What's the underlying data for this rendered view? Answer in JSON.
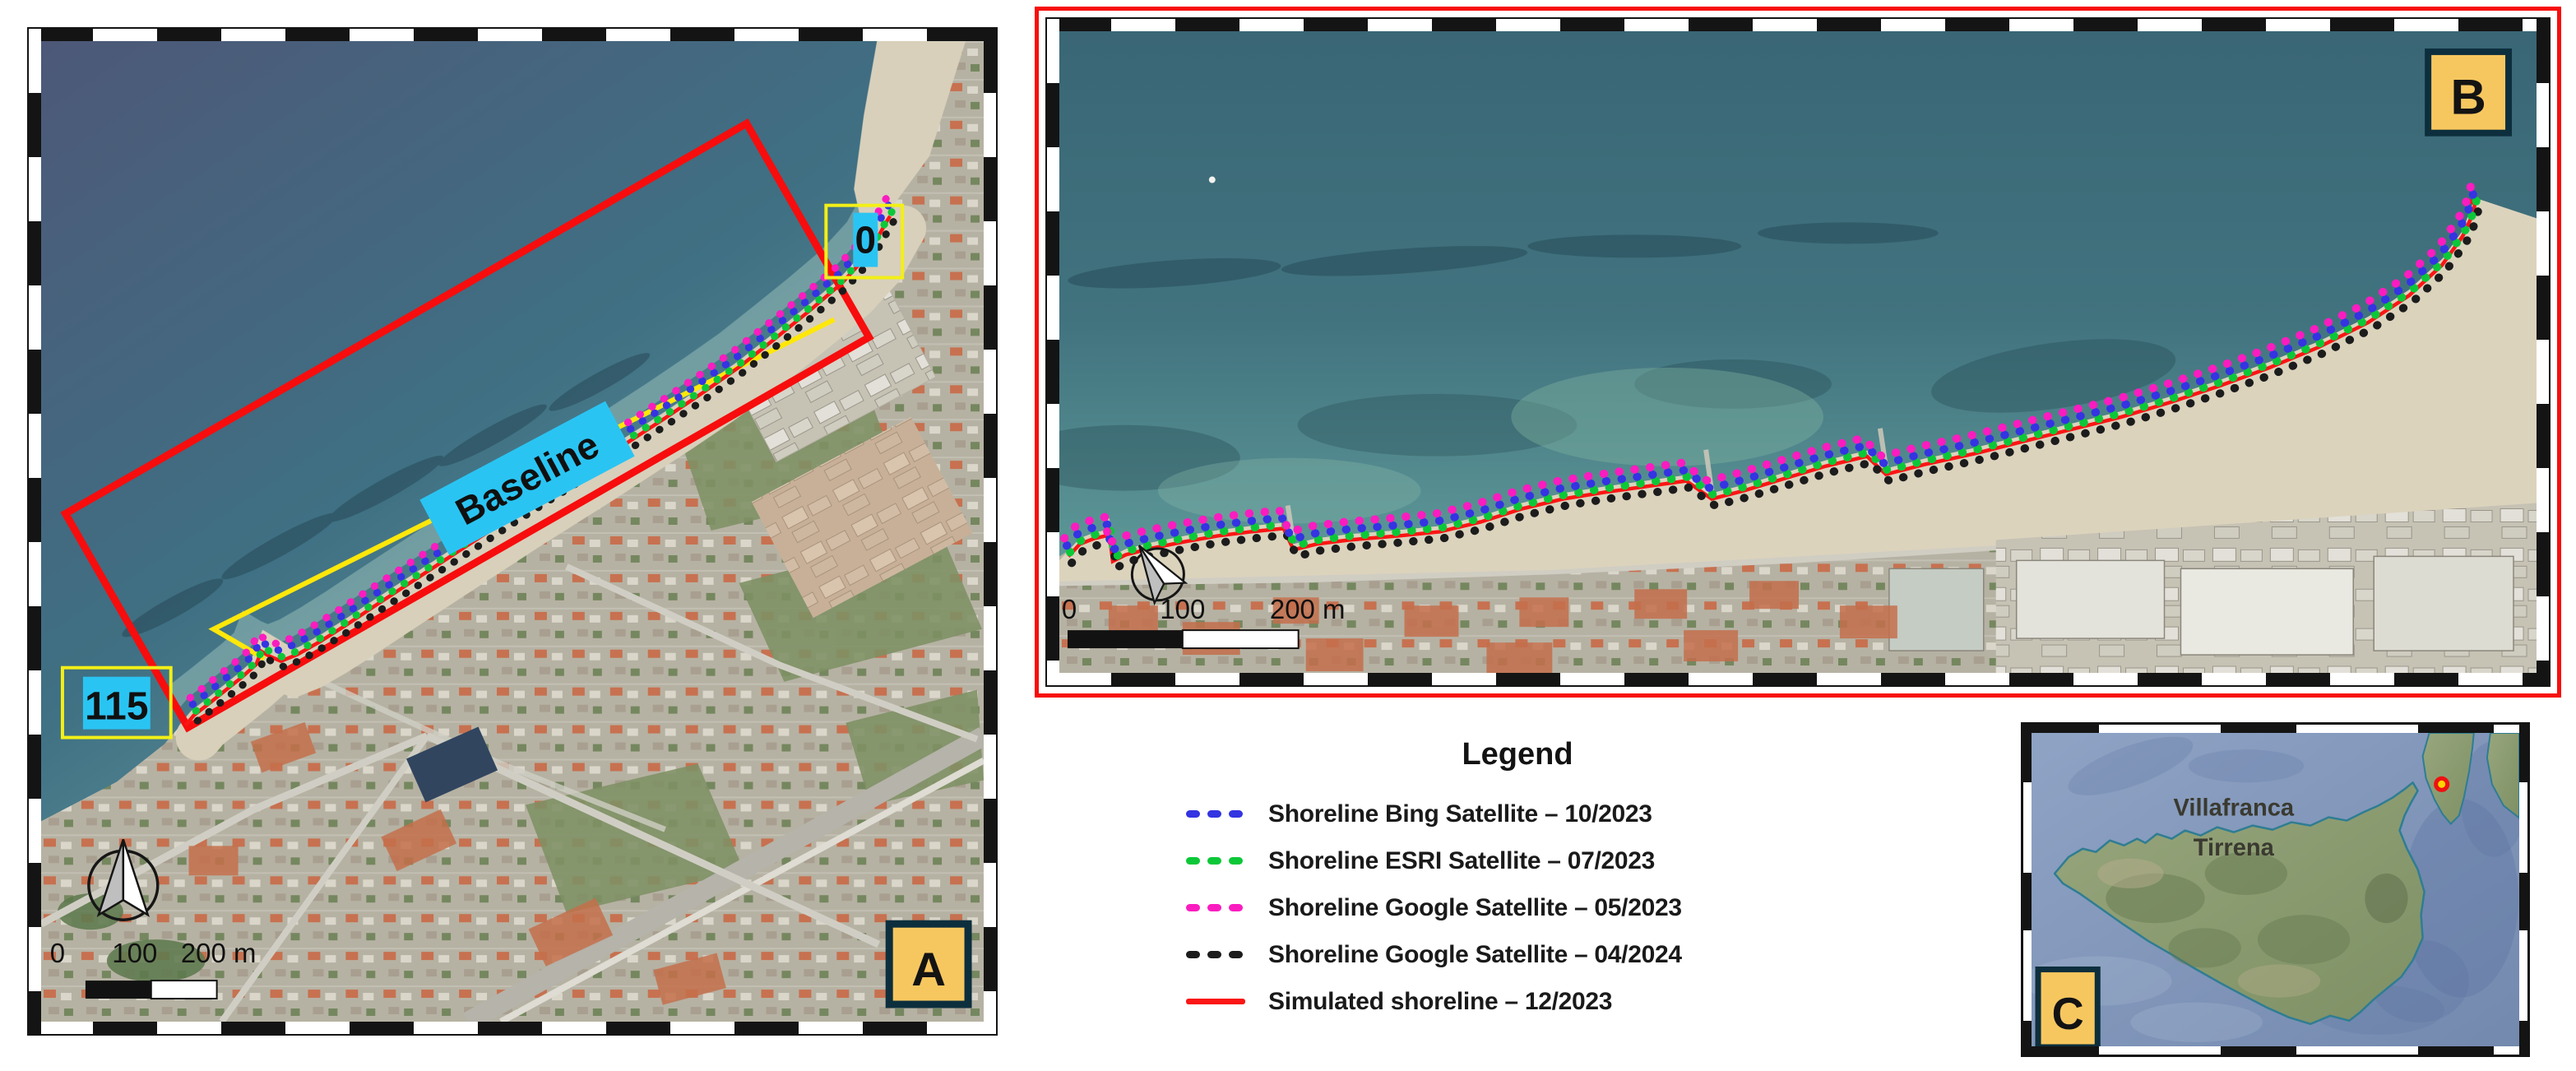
{
  "figure": {
    "description": "Shoreline comparison map figure, three panels A/B/C"
  },
  "colors": {
    "accent_red": "#f70d0d",
    "baseline_yellow": "#ffe70a",
    "label_cyan": "#2ac4f3",
    "panel_label_bg": "#f7c75f",
    "panel_label_border": "#0d2f3d",
    "legend_blue": "#3434e2",
    "legend_green": "#0cc838",
    "legend_magenta": "#fb1cc0",
    "legend_black": "#1c1c1c",
    "legend_red": "#fb1515"
  },
  "panel_a": {
    "label": "A",
    "transect_marker_start": "0",
    "transect_marker_end": "115",
    "baseline_label": "Baseline",
    "scalebar": {
      "tick0": "0",
      "tick1": "100",
      "tick2": "200 m"
    }
  },
  "panel_b": {
    "label": "B",
    "scalebar": {
      "tick0": "0",
      "tick1": "100",
      "tick2": "200 m"
    }
  },
  "panel_c": {
    "label": "C",
    "place_line1": "Villafranca",
    "place_line2": "Tirrena"
  },
  "legend": {
    "title": "Legend",
    "items": [
      {
        "label": "Shoreline Bing Satellite – 10/2023",
        "color": "#3434e2",
        "style": "dashed"
      },
      {
        "label": "Shoreline ESRI Satellite – 07/2023",
        "color": "#0cc838",
        "style": "dashed"
      },
      {
        "label": "Shoreline Google Satellite – 05/2023",
        "color": "#fb1cc0",
        "style": "dashed"
      },
      {
        "label": "Shoreline Google Satellite – 04/2024",
        "color": "#1c1c1c",
        "style": "dashed"
      },
      {
        "label": "Simulated shoreline – 12/2023",
        "color": "#fb1515",
        "style": "solid"
      }
    ]
  }
}
